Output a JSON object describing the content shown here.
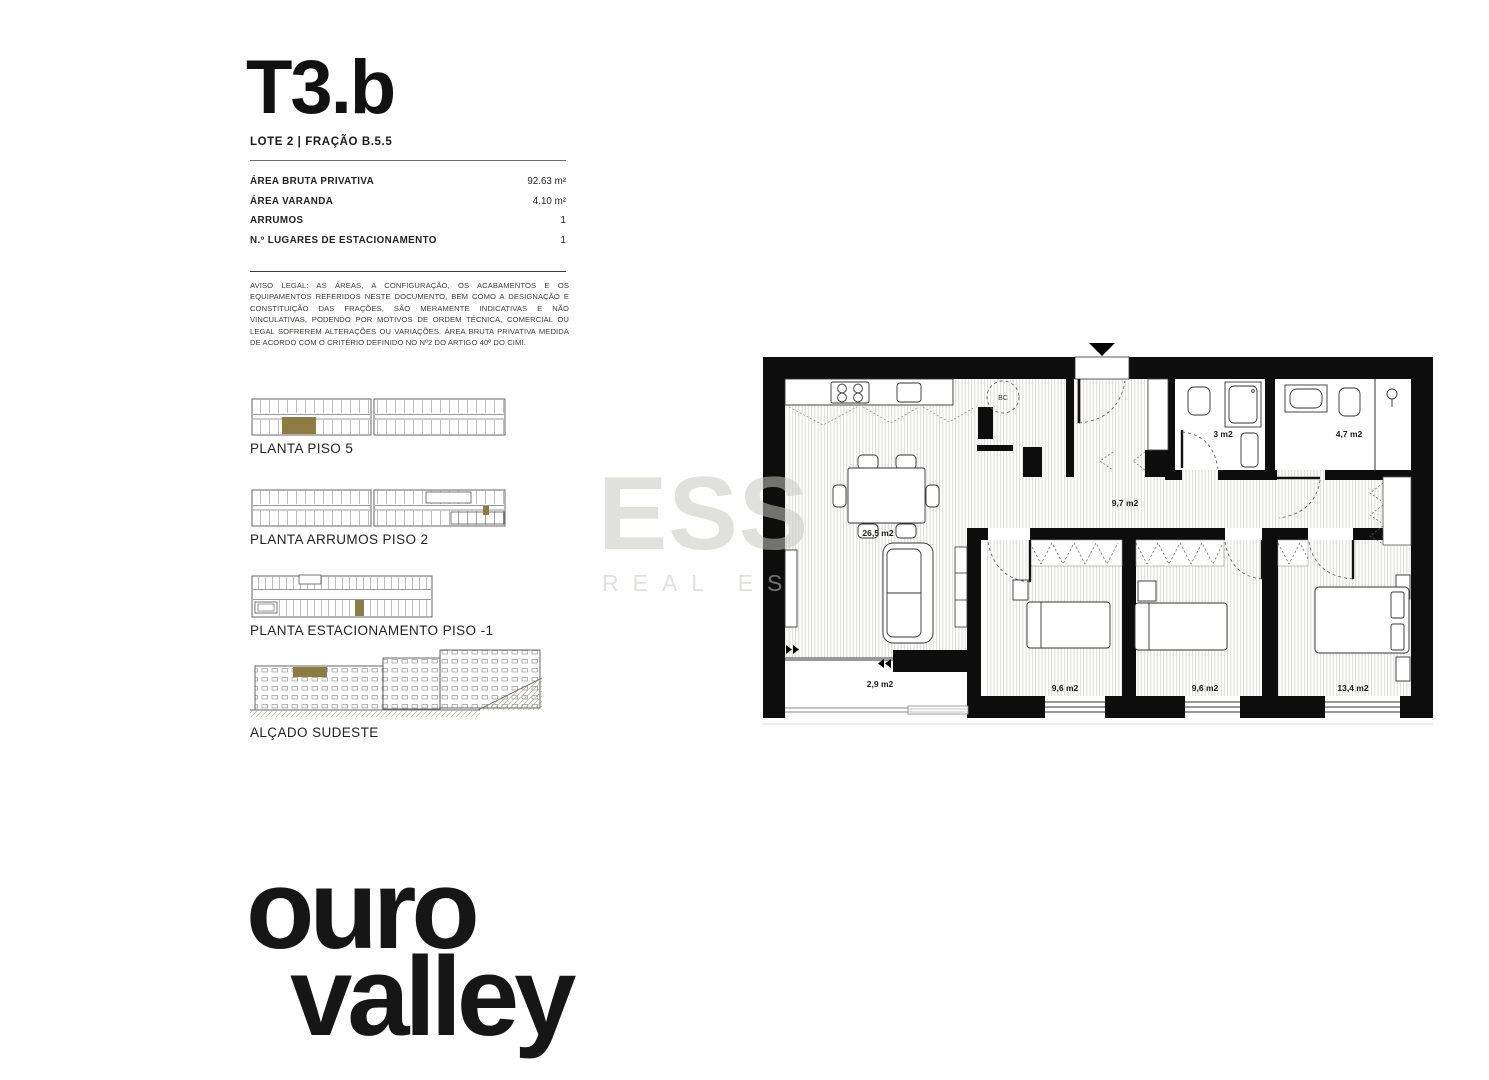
{
  "page": {
    "background": "#ffffff",
    "accent_gold": "#8d7b41"
  },
  "header": {
    "title": "T3.b",
    "subtitle": "LOTE 2 | FRAÇÃO B.5.5"
  },
  "details": {
    "rows": [
      {
        "label": "ÁREA BRUTA PRIVATIVA",
        "value": "92.63 m²"
      },
      {
        "label": "ÁREA VARANDA",
        "value": "4.10 m²"
      },
      {
        "label": "ARRUMOS",
        "value": "1"
      },
      {
        "label": "N.º LUGARES DE ESTACIONAMENTO",
        "value": "1"
      }
    ]
  },
  "disclaimer": "AVISO LEGAL: AS ÁREAS, A CONFIGURAÇÃO, OS ACABAMENTOS E OS EQUIPAMENTOS REFERIDOS NESTE DOCUMENTO, BEM COMO A DESIGNAÇÃO E CONSTITUIÇÃO DAS FRAÇÕES, SÃO MERAMENTE INDICATIVAS E NÃO VINCULATIVAS, PODENDO POR MOTIVOS DE ORDEM TÉCNICA, COMERCIAL OU LEGAL SOFREREM ALTERAÇÕES OU VARIAÇÕES. ÁREA BRUTA PRIVATIVA MEDIDA DE ACORDO COM O CRITÉRIO DEFINIDO NO Nº2 DO ARTIGO 40º DO CIMI.",
  "thumbnails": [
    {
      "caption": "PLANTA PISO 5"
    },
    {
      "caption": "PLANTA ARRUMOS PISO 2"
    },
    {
      "caption": "PLANTA ESTACIONAMENTO PISO -1"
    },
    {
      "caption": "ALÇADO SUDESTE"
    }
  ],
  "floorplan": {
    "rooms": [
      {
        "name": "kitchen-living",
        "area_label": "26,5 m2"
      },
      {
        "name": "hall",
        "area_label": "9,7 m2"
      },
      {
        "name": "bathroom-1",
        "area_label": "3 m2"
      },
      {
        "name": "bathroom-2",
        "area_label": "4,7 m2"
      },
      {
        "name": "balcony",
        "area_label": "2,9 m2"
      },
      {
        "name": "bedroom-1",
        "area_label": "9,6 m2"
      },
      {
        "name": "bedroom-2",
        "area_label": "9,6 m2"
      },
      {
        "name": "bedroom-3",
        "area_label": "13,4 m2"
      }
    ],
    "equipment_label": "BC"
  },
  "watermark": {
    "line1": "ESS",
    "line2": "REAL ES"
  },
  "logo": {
    "line1": "ouro",
    "line2": "valley"
  }
}
